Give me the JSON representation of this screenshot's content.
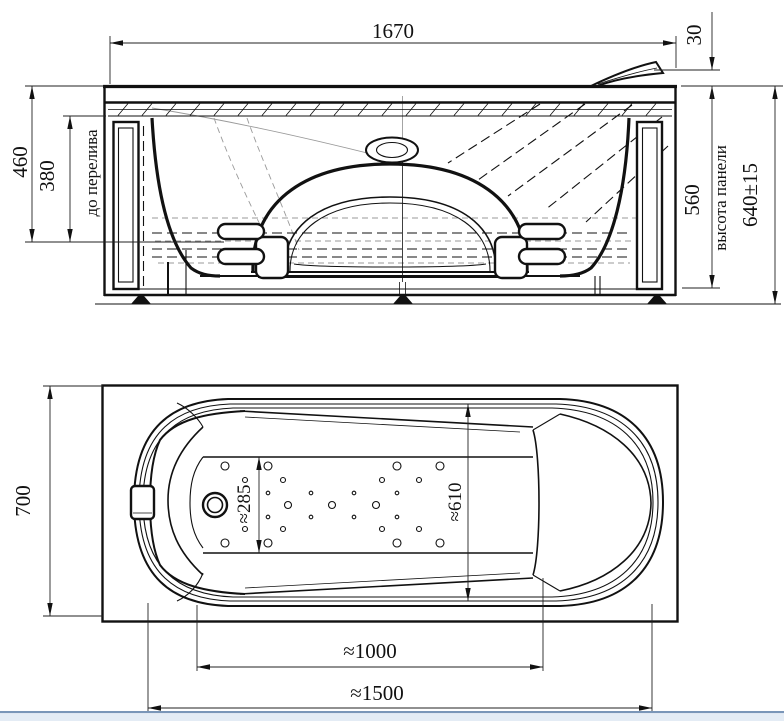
{
  "front_view": {
    "overall_length": "1670",
    "spout_overhang": "30",
    "depth_total": "460",
    "depth_to_overflow": "380",
    "overflow_label": "до перелива",
    "rim_height": "560",
    "panel_height_label": "высота панели",
    "overall_height": "640±15"
  },
  "plan_view": {
    "overall_width": "700",
    "floor_width": "≈285",
    "inner_width": "≈610",
    "floor_length": "≈1000",
    "inner_length": "≈1500"
  },
  "colors": {
    "ink": "#111111",
    "gray_line": "#9a9a9a",
    "window_bar_line": "#7a96b8",
    "window_bar_fill": "#e4ecf5"
  }
}
